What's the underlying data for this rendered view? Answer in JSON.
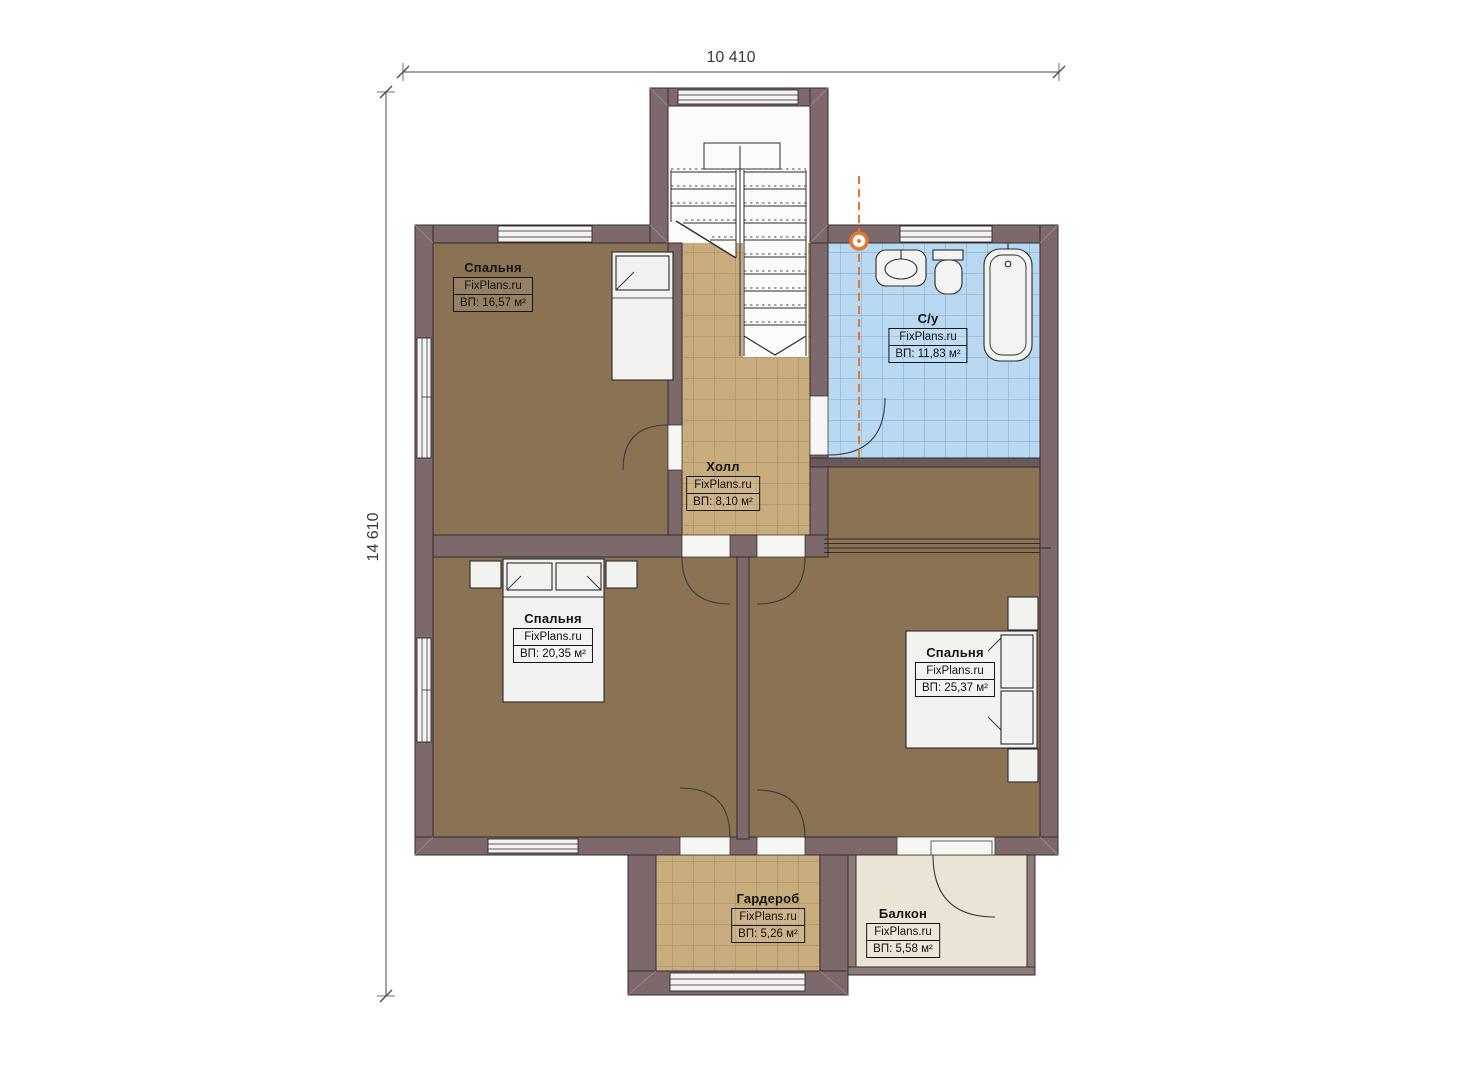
{
  "dimensions": {
    "width_label": "10 410",
    "height_label": "14 610"
  },
  "rooms": {
    "bedroom_top_left": {
      "name": "Спальня",
      "brand": "FixPlans.ru",
      "area": "ВП: 16,57 м²"
    },
    "bathroom": {
      "name": "С/у",
      "brand": "FixPlans.ru",
      "area": "ВП: 11,83 м²"
    },
    "hall": {
      "name": "Холл",
      "brand": "FixPlans.ru",
      "area": "ВП: 8,10 м²"
    },
    "bedroom_bottom_left": {
      "name": "Спальня",
      "brand": "FixPlans.ru",
      "area": "ВП: 20,35 м²"
    },
    "bedroom_right": {
      "name": "Спальня",
      "brand": "FixPlans.ru",
      "area": "ВП: 25,37 м²"
    },
    "wardrobe": {
      "name": "Гардероб",
      "brand": "FixPlans.ru",
      "area": "ВП: 5,26 м²"
    },
    "balcony": {
      "name": "Балкон",
      "brand": "FixPlans.ru",
      "area": "ВП: 5,58 м²"
    }
  },
  "colors": {
    "wall": "#7d686b",
    "bedroom_floor": "#8a7253",
    "tile_floor": "#c8ac7e",
    "bath_floor": "#b9d8f1",
    "balcony_floor": "#ebe3d3",
    "marker_orange": "#e8762c"
  }
}
